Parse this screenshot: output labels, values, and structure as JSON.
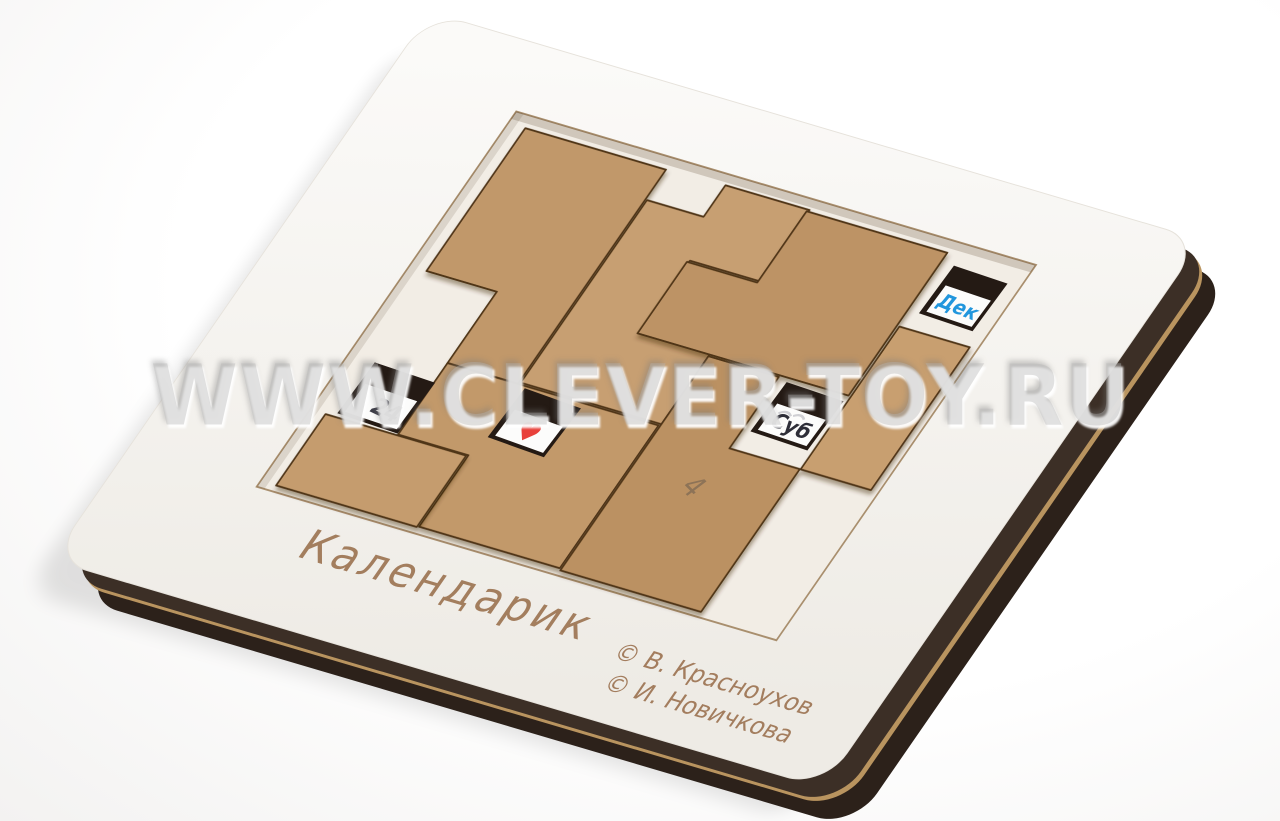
{
  "scene": {
    "watermark": "WWW.CLEVER-TOY.RU",
    "background_color": "#ffffff"
  },
  "board": {
    "title": "Календарик",
    "credits": [
      "© В. Красноухов",
      "© И. Новичкова"
    ],
    "face_color": "#f8f5f0",
    "edge_dark_color": "#3c2f26",
    "edge_bottom_color": "#2c211a",
    "edge_tan_color": "#b9945f",
    "engraving_color": "#9b7250"
  },
  "pieces": {
    "wood_color": "#c39a6b",
    "cut_color": "#503418",
    "pencil_mark": "4"
  },
  "tray": {
    "floor_color": "#f2ede5"
  },
  "windows": {
    "day": {
      "value": "24",
      "text_color": "#3c3c46"
    },
    "heart": {
      "value": "♥",
      "text_color": "#e8403a"
    },
    "weekday": {
      "value": "Суб",
      "text_color": "#2e2e38"
    },
    "month": {
      "value": "Дек",
      "text_color": "#2196dd"
    }
  }
}
